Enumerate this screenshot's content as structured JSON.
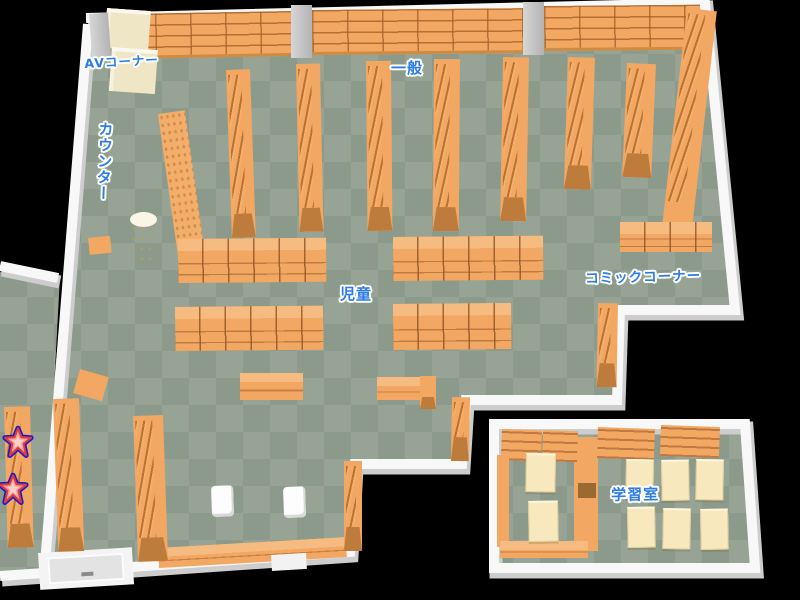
{
  "map": {
    "areas": [
      {
        "id": "av-corner",
        "label": "AVコーナー"
      },
      {
        "id": "general",
        "label": "一般"
      },
      {
        "id": "counter",
        "label": "カウンター"
      },
      {
        "id": "children",
        "label": "児童"
      },
      {
        "id": "comic-corner",
        "label": "コミックコーナー"
      },
      {
        "id": "study-room",
        "label": "学習室"
      }
    ],
    "markers": [
      {
        "id": "star-marker-1",
        "icon": "star"
      },
      {
        "id": "star-marker-2",
        "icon": "star"
      }
    ],
    "colors": {
      "background": "#000000",
      "floor_light": "#96a395",
      "floor_dark": "#8b9a8a",
      "wall": "#f8f8f8",
      "wall_shadow": "#cdcdcd",
      "shelf": "#f2a763",
      "shelf_line": "#b97a38",
      "shelf_dark": "#bd7b3c",
      "shelf_band": "#f6bb80",
      "table": "#f7e9bd",
      "label_blue": "#2b7ce8",
      "star_outline": "#1a18cf",
      "star_red": "#dc3c3c",
      "star_fill": "#f4a09a"
    }
  }
}
